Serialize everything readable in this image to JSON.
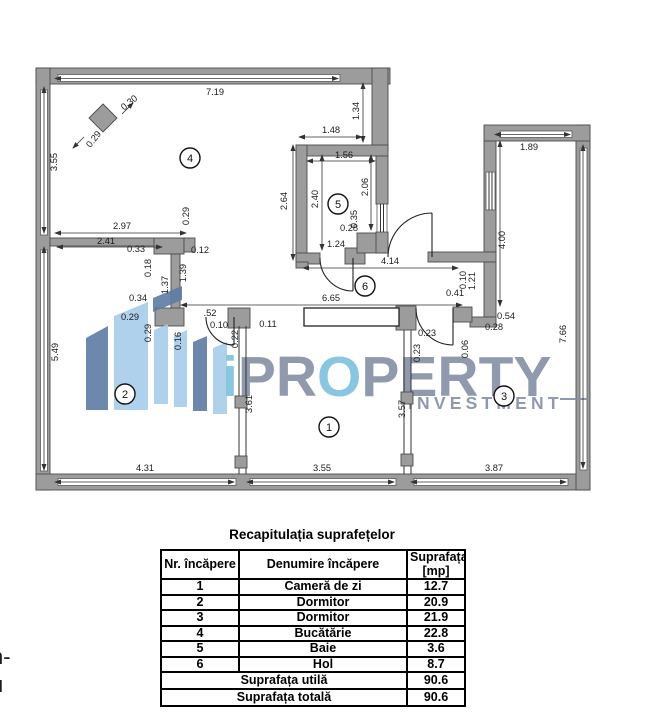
{
  "floorplan": {
    "colors": {
      "wall_fill": "#9c9c9c",
      "wall_stroke": "#4d4d4d",
      "dim_text": "#1c1c1c",
      "logo_dark_blue": "#5e7ca4",
      "logo_light_blue": "#a7cdea",
      "logo_text_gray": "#868fa5",
      "logo_text_blue": "#7fc0de"
    },
    "rooms": [
      {
        "number": "1",
        "x": 329,
        "y": 427
      },
      {
        "number": "2",
        "x": 125,
        "y": 394
      },
      {
        "number": "3",
        "x": 504,
        "y": 396
      },
      {
        "number": "4",
        "x": 190,
        "y": 158
      },
      {
        "number": "5",
        "x": 338,
        "y": 204
      },
      {
        "number": "6",
        "x": 365,
        "y": 286
      }
    ],
    "dimensions": [
      {
        "t": "7.19",
        "x": 215,
        "y": 95,
        "r": 0
      },
      {
        "t": "0.30",
        "x": 131,
        "y": 105,
        "r": -38
      },
      {
        "t": "0.29",
        "x": 96,
        "y": 141,
        "r": -52
      },
      {
        "t": "3.55",
        "x": 57,
        "y": 162,
        "r": -90
      },
      {
        "t": "1.34",
        "x": 359,
        "y": 111,
        "r": -90
      },
      {
        "t": "1.48",
        "x": 331,
        "y": 133,
        "r": 0
      },
      {
        "t": "1.56",
        "x": 344,
        "y": 158,
        "r": 0
      },
      {
        "t": "1.89",
        "x": 529,
        "y": 150,
        "r": 0
      },
      {
        "t": "2.64",
        "x": 287,
        "y": 201,
        "r": -90
      },
      {
        "t": "2.40",
        "x": 318,
        "y": 199,
        "r": -90
      },
      {
        "t": "2.06",
        "x": 368,
        "y": 187,
        "r": -90
      },
      {
        "t": "0.35",
        "x": 357,
        "y": 219,
        "r": -90
      },
      {
        "t": "0.28",
        "x": 349,
        "y": 231,
        "r": 0
      },
      {
        "t": "1.24",
        "x": 336,
        "y": 247,
        "r": 0
      },
      {
        "t": "4.14",
        "x": 390,
        "y": 264,
        "r": 0
      },
      {
        "t": "2.97",
        "x": 122,
        "y": 229,
        "r": 0
      },
      {
        "t": "2.41",
        "x": 106,
        "y": 244,
        "r": 0
      },
      {
        "t": "0.33",
        "x": 136,
        "y": 252,
        "r": 0
      },
      {
        "t": "0.12",
        "x": 200,
        "y": 253,
        "r": 0
      },
      {
        "t": "0.29",
        "x": 189,
        "y": 216,
        "r": -90
      },
      {
        "t": "0.18",
        "x": 151,
        "y": 268,
        "r": -90
      },
      {
        "t": "1.37",
        "x": 168,
        "y": 285,
        "r": -90
      },
      {
        "t": "1.39",
        "x": 186,
        "y": 273,
        "r": -90
      },
      {
        "t": "0.34",
        "x": 138,
        "y": 301,
        "r": 0
      },
      {
        "t": "0.29",
        "x": 130,
        "y": 320,
        "r": 0
      },
      {
        "t": "0.29",
        "x": 151,
        "y": 333,
        "r": -90
      },
      {
        "t": "0.16",
        "x": 181,
        "y": 341,
        "r": -90
      },
      {
        "t": ".52",
        "x": 210,
        "y": 316,
        "r": 0
      },
      {
        "t": "0.10",
        "x": 219,
        "y": 328,
        "r": 0
      },
      {
        "t": "0.22",
        "x": 238,
        "y": 339,
        "r": -90
      },
      {
        "t": "0.11",
        "x": 268,
        "y": 327,
        "r": 0
      },
      {
        "t": "6.65",
        "x": 331,
        "y": 301,
        "r": 0
      },
      {
        "t": "4.00",
        "x": 505,
        "y": 240,
        "r": -90
      },
      {
        "t": "0.10",
        "x": 466,
        "y": 280,
        "r": -90
      },
      {
        "t": "1.21",
        "x": 475,
        "y": 281,
        "r": -90
      },
      {
        "t": "0.41",
        "x": 455,
        "y": 296,
        "r": 0
      },
      {
        "t": "0.54",
        "x": 506,
        "y": 319,
        "r": 0
      },
      {
        "t": "0.28",
        "x": 494,
        "y": 330,
        "r": 0
      },
      {
        "t": "0.23",
        "x": 427,
        "y": 336,
        "r": 0
      },
      {
        "t": "0.23",
        "x": 420,
        "y": 353,
        "r": -90
      },
      {
        "t": "0.06",
        "x": 468,
        "y": 349,
        "r": -90
      },
      {
        "t": "7.66",
        "x": 566,
        "y": 334,
        "r": -90
      },
      {
        "t": "5.49",
        "x": 58,
        "y": 352,
        "r": -90
      },
      {
        "t": "3.61",
        "x": 252,
        "y": 404,
        "r": -90
      },
      {
        "t": "3.57",
        "x": 405,
        "y": 409,
        "r": -90
      },
      {
        "t": "4.31",
        "x": 145,
        "y": 471,
        "r": 0
      },
      {
        "t": "3.55",
        "x": 322,
        "y": 471,
        "r": 0
      },
      {
        "t": "3.87",
        "x": 494,
        "y": 471,
        "r": 0
      }
    ]
  },
  "watermark": {
    "brand_i": "i",
    "brand_pr": "PR",
    "brand_o": "O",
    "brand_perty": "PERTY",
    "subtext": "INVESTMENT"
  },
  "summary_table": {
    "title": "Recapitulația suprafețelor",
    "col_headers": [
      "Nr. încăpere",
      "Denumire încăpere",
      "Suprafața\n[mp]"
    ],
    "rows": [
      {
        "nr": "1",
        "name": "Cameră de zi",
        "area": "12.7"
      },
      {
        "nr": "2",
        "name": "Dormitor",
        "area": "20.9"
      },
      {
        "nr": "3",
        "name": "Dormitor",
        "area": "21.9"
      },
      {
        "nr": "4",
        "name": "Bucătărie",
        "area": "22.8"
      },
      {
        "nr": "5",
        "name": "Baie",
        "area": "3.6"
      },
      {
        "nr": "6",
        "name": "Hol",
        "area": "8.7"
      }
    ],
    "footer_rows": [
      {
        "label": "Suprafața utilă",
        "area": "90.6"
      },
      {
        "label": "Suprafața totală",
        "area": "90.6"
      }
    ]
  },
  "edge_fragments": {
    "line1": "n-",
    "line2": "u"
  }
}
